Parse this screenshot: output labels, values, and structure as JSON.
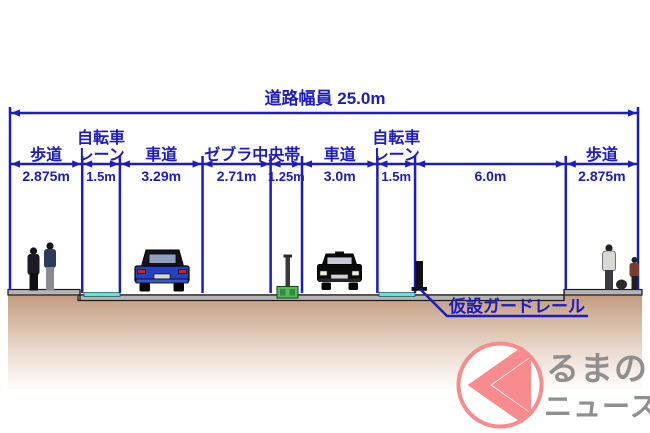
{
  "diagram": {
    "title": "道路幅員 25.0m",
    "total_width_m": 25.0,
    "sections": [
      {
        "label_lines": [
          "歩道"
        ],
        "value": "2.875m",
        "width_m": 2.875,
        "surface": "sidewalk"
      },
      {
        "label_lines": [
          "自転車",
          "レーン"
        ],
        "value": "1.5m",
        "width_m": 1.5,
        "surface": "bicycle-lane"
      },
      {
        "label_lines": [
          "車道"
        ],
        "value": "3.29m",
        "width_m": 3.29,
        "surface": "roadway"
      },
      {
        "label_lines": [
          "ゼブラ中央帯"
        ],
        "value": "2.71m",
        "width_m": 2.71,
        "surface": "zebra-median",
        "label_span": 2
      },
      {
        "label_lines": [],
        "value": "1.25m",
        "width_m": 1.25,
        "surface": "median"
      },
      {
        "label_lines": [
          "車道"
        ],
        "value": "3.0m",
        "width_m": 3.0,
        "surface": "roadway"
      },
      {
        "label_lines": [
          "自転車",
          "レーン"
        ],
        "value": "1.5m",
        "width_m": 1.5,
        "surface": "bicycle-lane"
      },
      {
        "label_lines": [],
        "value": "6.0m",
        "width_m": 6.0,
        "surface": "roadway"
      },
      {
        "label_lines": [
          "歩道"
        ],
        "value": "2.875m",
        "width_m": 2.875,
        "surface": "sidewalk"
      }
    ],
    "annotation": {
      "guardrail_label": "仮設ガードレール"
    },
    "colors": {
      "dimension_blue": "#1c1cc0",
      "bicycle_lane_cyan": "#63e2de",
      "road_gray": "#b5b5b5",
      "ground_brown": "#c6a289",
      "median_box_green": "#59b95f",
      "logo_pink": "#f78b8e",
      "logo_gray": "#8f8f8f"
    }
  },
  "logo": {
    "glyph": "く",
    "text_line1": "るまの",
    "text_line2": "ニュース"
  }
}
